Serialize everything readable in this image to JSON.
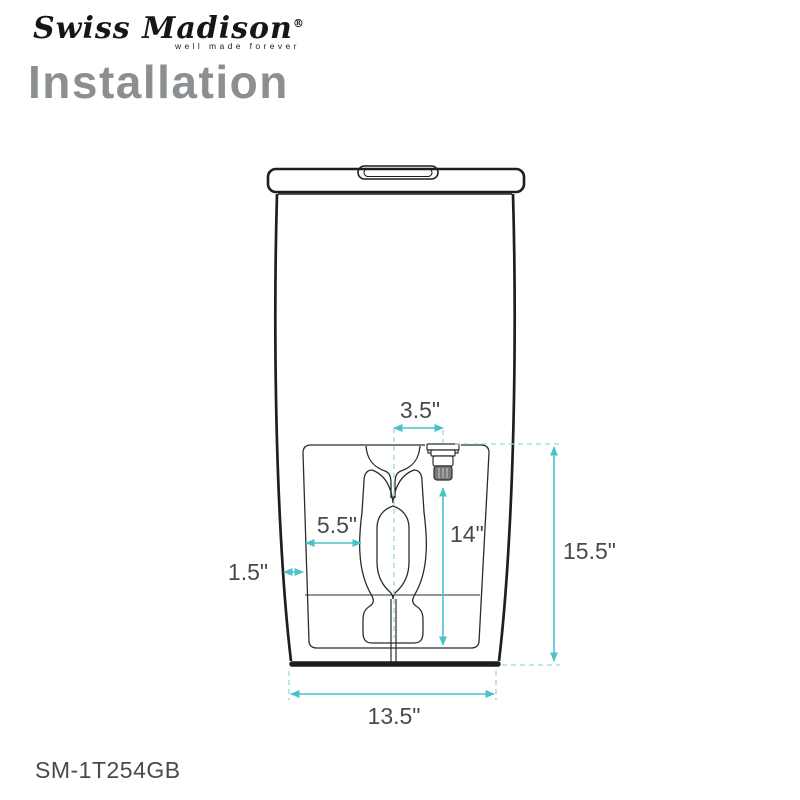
{
  "brand": {
    "name": "Swiss Madison",
    "registered": "®",
    "tagline": "well made forever"
  },
  "page": {
    "title": "Installation",
    "product_code": "SM-1T254GB"
  },
  "diagram": {
    "subject": "one-piece toilet front view with cutaway of trapway and water supply valve",
    "accent_color": "#4bc2c8",
    "line_color": "#1e1e1e",
    "dimensions": {
      "valve_offset": "3.5\"",
      "trap_offset": "5.5\"",
      "side_wall": "1.5\"",
      "valve_height": "14\"",
      "overall_height": "15.5\"",
      "base_width": "13.5\""
    }
  }
}
